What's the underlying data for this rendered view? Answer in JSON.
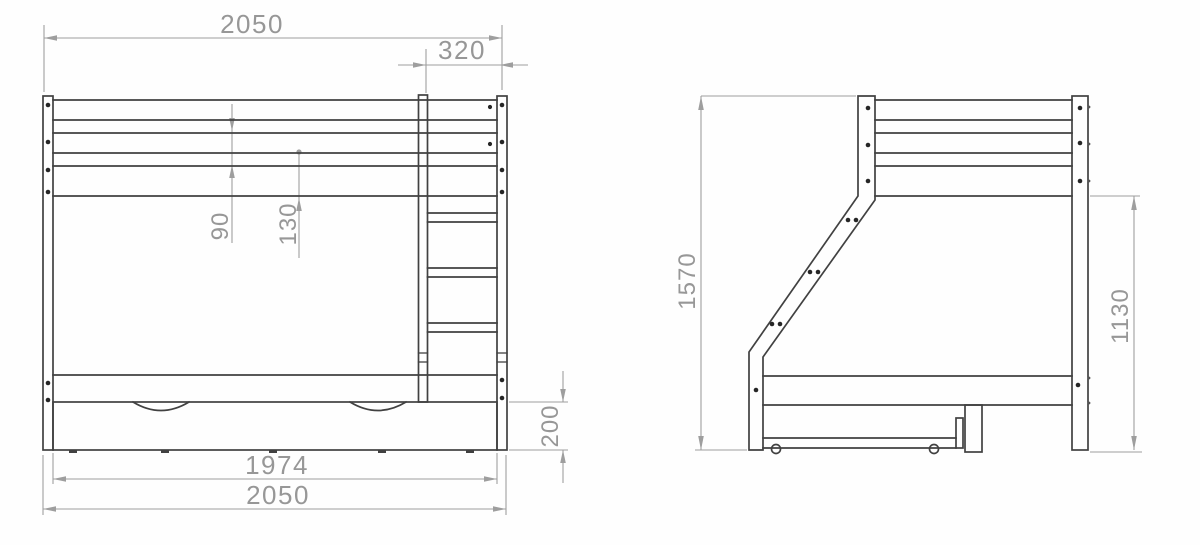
{
  "drawing": {
    "type": "technical-drawing",
    "subject": "bunk bed with under-bed storage drawer, front elevation and side elevation",
    "colors": {
      "outline": "#414141",
      "dimension_lines": "#9e9e9e",
      "dimension_text": "#979797",
      "background": "#ffffff"
    },
    "front_view": {
      "dimensions": {
        "overall_width_top": "2050",
        "ladder_width": "320",
        "rail_gap_a": "90",
        "rail_gap_b": "130",
        "drawer_height": "200",
        "drawer_width": "1974",
        "overall_width_bottom": "2050"
      }
    },
    "side_view": {
      "dimensions": {
        "overall_height": "1570",
        "upper_bunk_underside_height": "1130"
      }
    }
  }
}
